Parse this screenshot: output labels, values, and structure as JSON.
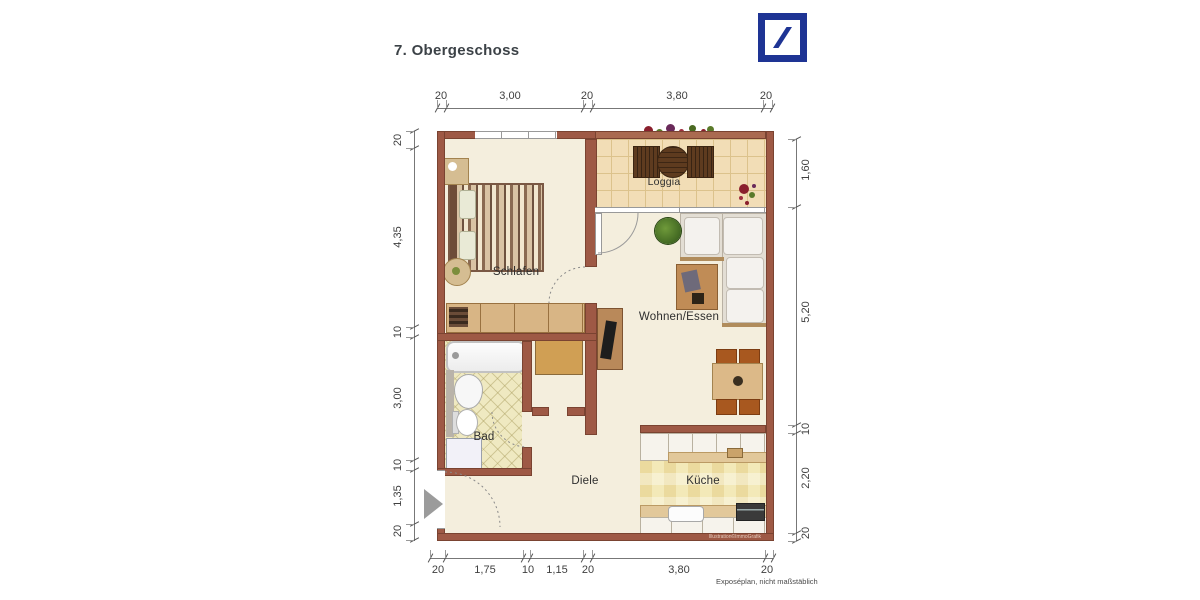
{
  "header": {
    "title": "7. Obergeschoss"
  },
  "logo": {
    "name": "Deutsche Bank",
    "color": "#1e3494"
  },
  "rooms": {
    "loggia": "Loggia",
    "schlafen": "Schlafen",
    "wohnen": "Wohnen/Essen",
    "bad": "Bad",
    "diele": "Diele",
    "kueche": "Küche"
  },
  "dims": {
    "top": [
      "20",
      "3,00",
      "20",
      "3,80",
      "20"
    ],
    "left": [
      "20",
      "4,35",
      "10",
      "3,00",
      "10",
      "1,35",
      "20"
    ],
    "right": [
      "1,60",
      "5,20",
      "10",
      "2,20",
      "20"
    ],
    "bottom": [
      "20",
      "1,75",
      "10",
      "1,15",
      "20",
      "3,80",
      "20"
    ]
  },
  "footer": {
    "note": "Exposéplan, nicht maßstäblich"
  },
  "watermark": "Illustration©ImmoGrafik",
  "colors": {
    "wall": "#9e5945",
    "floor": "#f4eedd",
    "loggia_floor": "#f2ddb6",
    "bad_floor": "#efe9c1",
    "kitchen_floor": "#f3e9b8",
    "logo_blue": "#1e3494"
  }
}
